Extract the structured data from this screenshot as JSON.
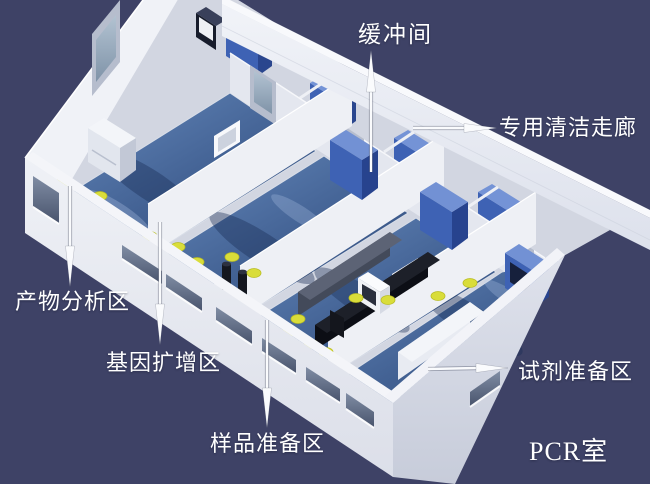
{
  "scene": {
    "description": "3D isometric cutaway rendering of a PCR laboratory floor plan",
    "background_color": "#3e4266",
    "palette": {
      "wall": "#e9ebf2",
      "wall_shadow": "#c8ccd9",
      "floor_blue": "#46689e",
      "floor_blue_dark": "#2c4878",
      "cabinet_blue": "#3e62b4",
      "equipment_black": "#0c0e15",
      "stool_yellow": "#d9dd3a",
      "label_text": "#ffffff"
    }
  },
  "callouts": [
    {
      "id": "buffer-room",
      "text": "缓冲间",
      "arrow_direction": "up"
    },
    {
      "id": "clean-corridor",
      "text": "专用清洁走廊",
      "arrow_direction": "right"
    },
    {
      "id": "product-analysis",
      "text": "产物分析区",
      "arrow_direction": "down"
    },
    {
      "id": "gene-amplification",
      "text": "基因扩增区",
      "arrow_direction": "down"
    },
    {
      "id": "sample-preparation",
      "text": "样品准备区",
      "arrow_direction": "down"
    },
    {
      "id": "reagent-preparation",
      "text": "试剂准备区",
      "arrow_direction": "right"
    }
  ],
  "caption": {
    "text": "PCR室"
  }
}
